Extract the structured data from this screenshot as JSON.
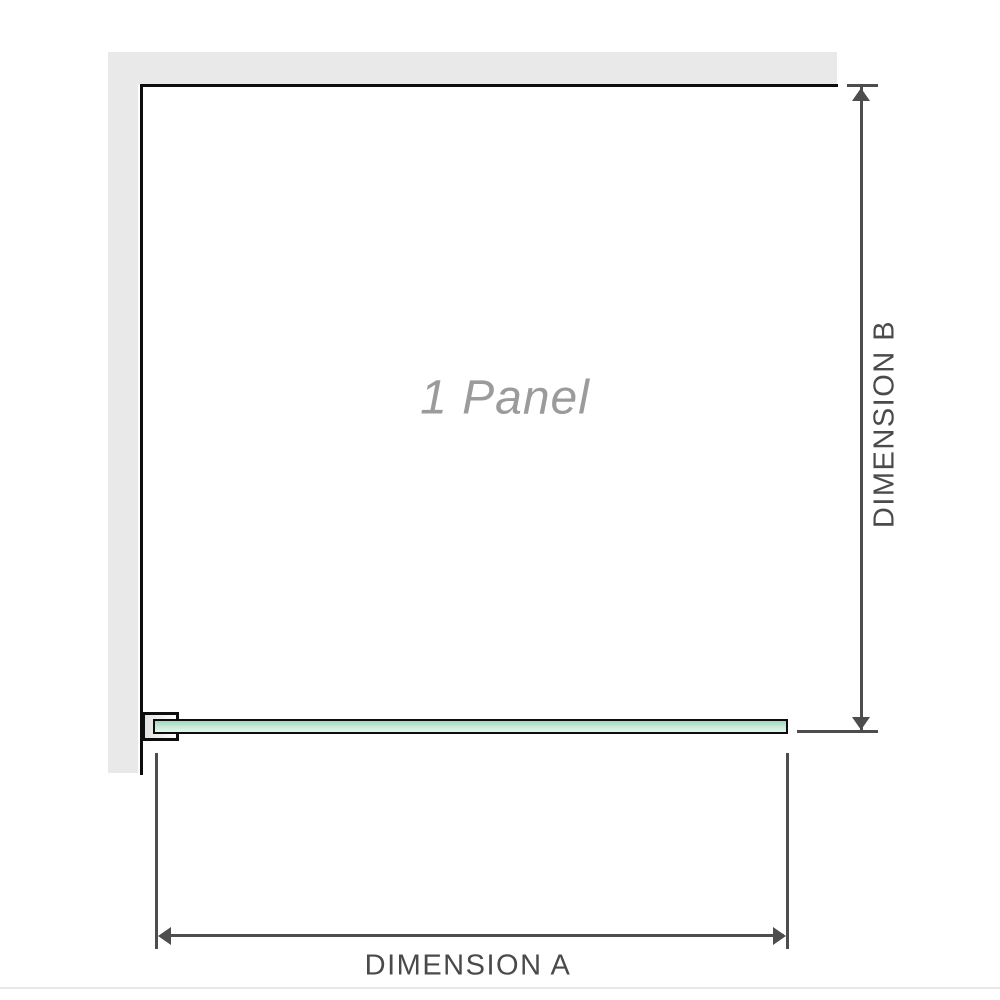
{
  "diagram": {
    "panel_label": "1 Panel",
    "dimension_a_label": "DIMENSION A",
    "dimension_b_label": "DIMENSION B"
  },
  "colors": {
    "background": "#ffffff",
    "wall_fill": "#e9e9e9",
    "outline": "#0d0d0d",
    "glass_top": "#9ed8ba",
    "glass_mid": "#c9ebd9",
    "glass_bottom": "#e8f6ee",
    "dimension_line": "#4d4d4d",
    "dimension_text": "#4a4a4a",
    "panel_text": "#9b9b9b",
    "baseline_rule": "#eae7e2"
  }
}
